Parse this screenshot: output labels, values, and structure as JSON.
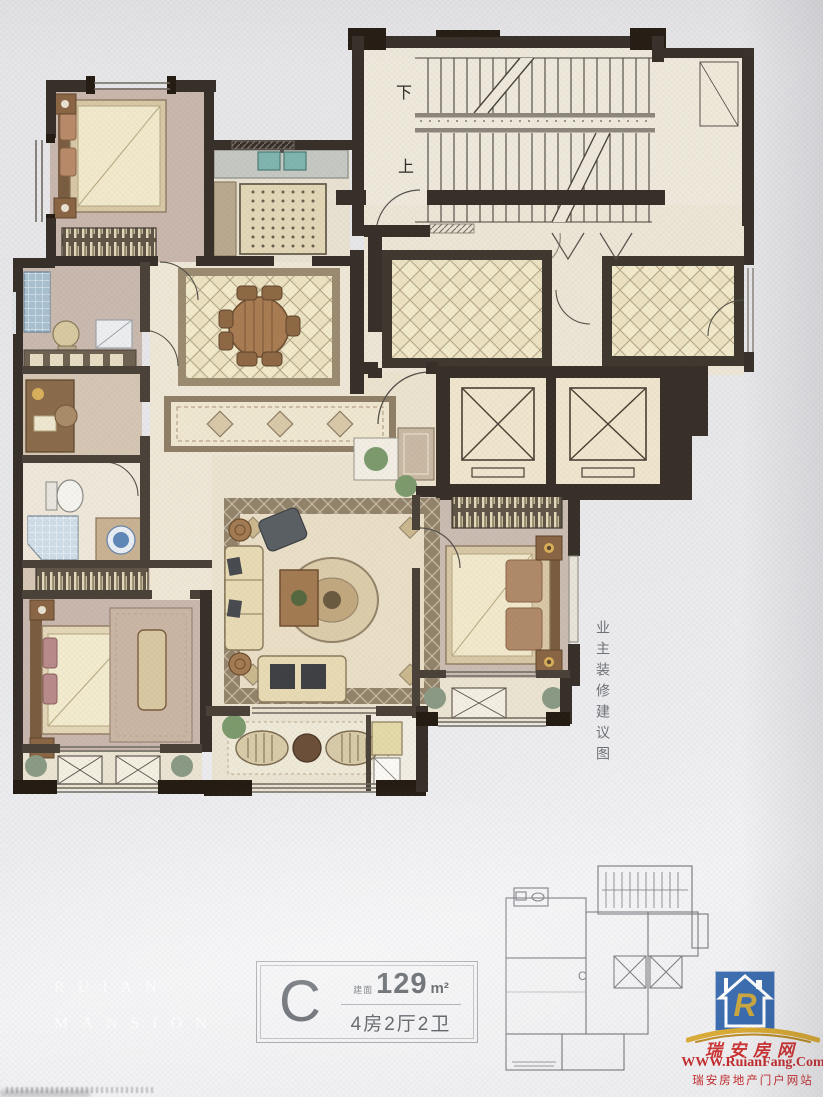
{
  "plan": {
    "stair_down_label": "下",
    "stair_up_label": "上",
    "side_note": "业主装修建议图"
  },
  "info_box": {
    "unit_label": "C",
    "area_prefix": "建面",
    "area_value": "129",
    "area_unit": "m²",
    "layout_text": "4房2厅2卫"
  },
  "watermark": {
    "line1": "RUIAN",
    "line2": "MANSION"
  },
  "key_plan": {
    "unit_label": "C"
  },
  "logo": {
    "monogram": "R",
    "site_name": "瑞安房网",
    "site_url": "WWW.RuianFang.Com",
    "tagline": "瑞安房地产门户网站"
  },
  "colors": {
    "paper": "#e8e8eb",
    "wall_dark": "#372f28",
    "wall_medium": "#4a4138",
    "floor_cream": "#efe7d6",
    "floor_mauve": "#c9b7ad",
    "tile_floor": "#ece2c2",
    "rug_border": "#93836a",
    "accent_red": "#c1282a",
    "logo_blue": "#2e63aa",
    "gold": "#c8a234"
  }
}
